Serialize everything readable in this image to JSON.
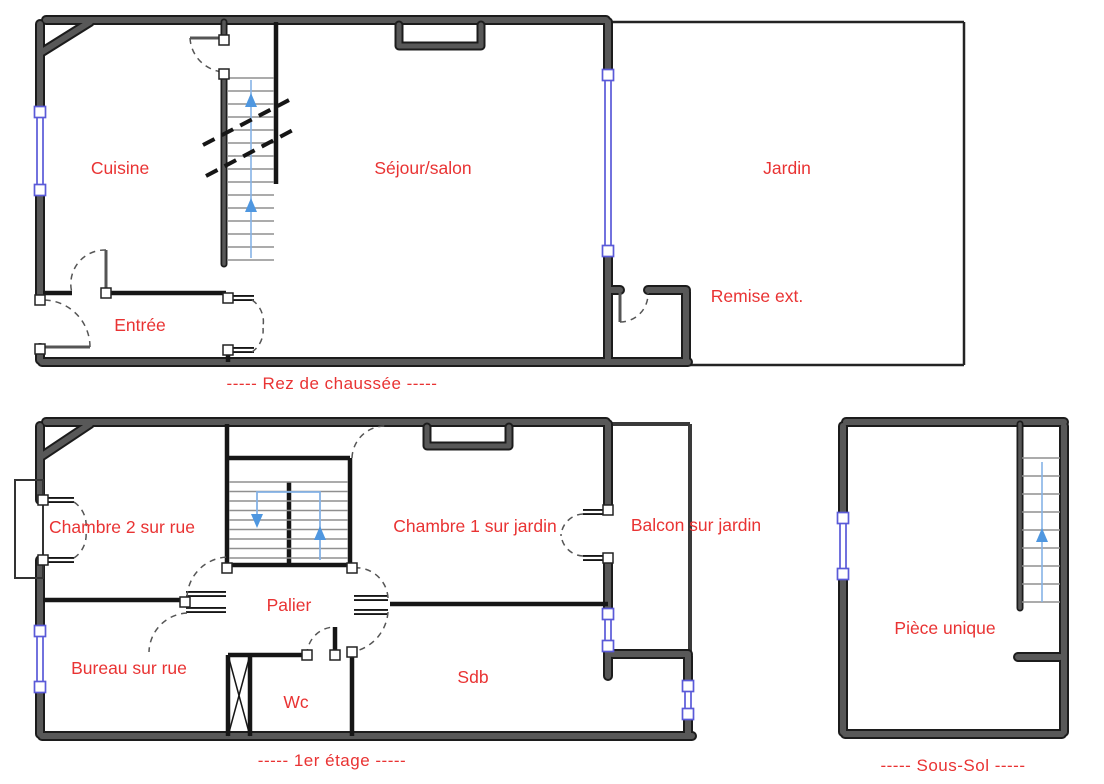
{
  "document": {
    "type": "floor-plan-drawing",
    "floor_count": 3
  },
  "colors": {
    "label": "#e93333",
    "wall": "#585858",
    "wall_dark": "#1c1c1c",
    "wall_mid": "#3a3a3a",
    "site_outline": "#242424",
    "window": "#5a5ad8",
    "arrow": "#4f97e0",
    "arrow_line": "#85b2e6",
    "tread": "#8f8f8f",
    "door": "#555555",
    "background": "#ffffff"
  },
  "icons": {
    "stairs_up_arrow": "triangle-up",
    "stairs_down_arrow": "triangle-down",
    "window_grip": "small-square",
    "duct_shaft": "crossed-box"
  },
  "floors": {
    "rdc": {
      "caption": "-----   Rez de chaussée   -----",
      "rooms": {
        "cuisine": "Cuisine",
        "sejour": "Séjour/salon",
        "jardin": "Jardin",
        "remise": "Remise ext.",
        "entree": "Entrée"
      }
    },
    "etage1": {
      "caption": "-----   1er étage   -----",
      "rooms": {
        "chambre2": "Chambre 2 sur rue",
        "chambre1": "Chambre 1 sur jardin",
        "balcon": "Balcon sur jardin",
        "palier": "Palier",
        "bureau": "Bureau sur rue",
        "wc": "Wc",
        "sdb": "Sdb"
      }
    },
    "soussol": {
      "caption": "-----   Sous-Sol   -----",
      "rooms": {
        "piece": "Pièce unique"
      }
    }
  }
}
